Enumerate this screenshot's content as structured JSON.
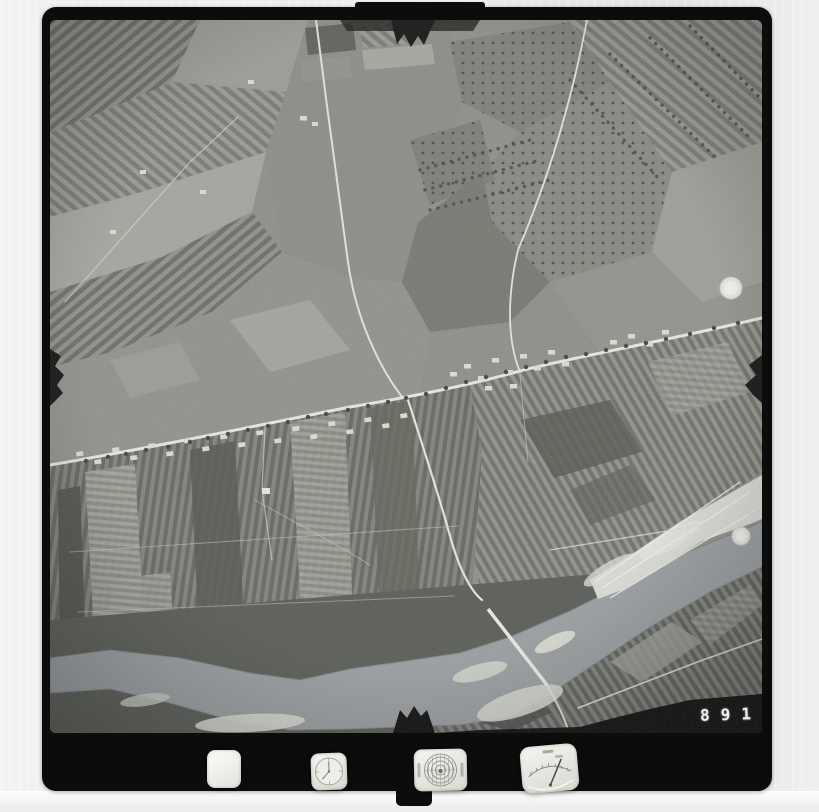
{
  "film_frame": {
    "frame_number": "891",
    "colors": {
      "scan_background": "#eceef0",
      "film_black": "#0c0c0c",
      "photo_midtone": "#8c8e88",
      "water_gray": "#999da0",
      "sandbar_light": "#dcded8",
      "road_light": "#e7e7e0",
      "frame_number_white": "#eef0ea"
    },
    "data_strip": {
      "windows": [
        "blank-window",
        "clock-dial",
        "level-bubble-dial",
        "altimeter-dial"
      ]
    },
    "fiducial_marks": [
      "top-center-notch",
      "left-middle-notch",
      "right-middle-notch",
      "bottom-center-notch"
    ],
    "photo_content": {
      "type": "black-and-white vertical aerial photograph",
      "landscape_features": [
        "patchwork farm fields",
        "narrow strip cultivation",
        "orchard tree rows",
        "linear roadside village",
        "road junction with straight road to bridge",
        "meandering river with bright sand bars"
      ]
    }
  }
}
